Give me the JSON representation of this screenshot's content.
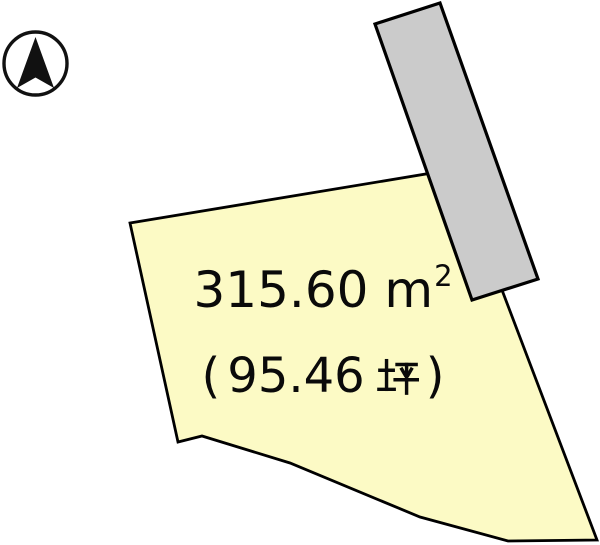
{
  "diagram": {
    "title": "land-parcel-survey-diagram",
    "parcel": {
      "area_sqm": {
        "value": "315.60",
        "unit_base": "m",
        "unit_exp": "2"
      },
      "area_tsubo": {
        "open_paren": "(",
        "value": "95.46",
        "unit": "坪",
        "close_paren": ")"
      }
    },
    "icons": {
      "north_arrow": "north-arrow-in-circle"
    },
    "colors": {
      "parcel_fill": "#FCFAC5",
      "parcel_stroke": "#000000",
      "road_fill": "#CBCBCB",
      "road_stroke": "#000000",
      "compass_color": "#111111",
      "text_color": "#0A0A0A",
      "background": "#FFFFFF"
    }
  }
}
